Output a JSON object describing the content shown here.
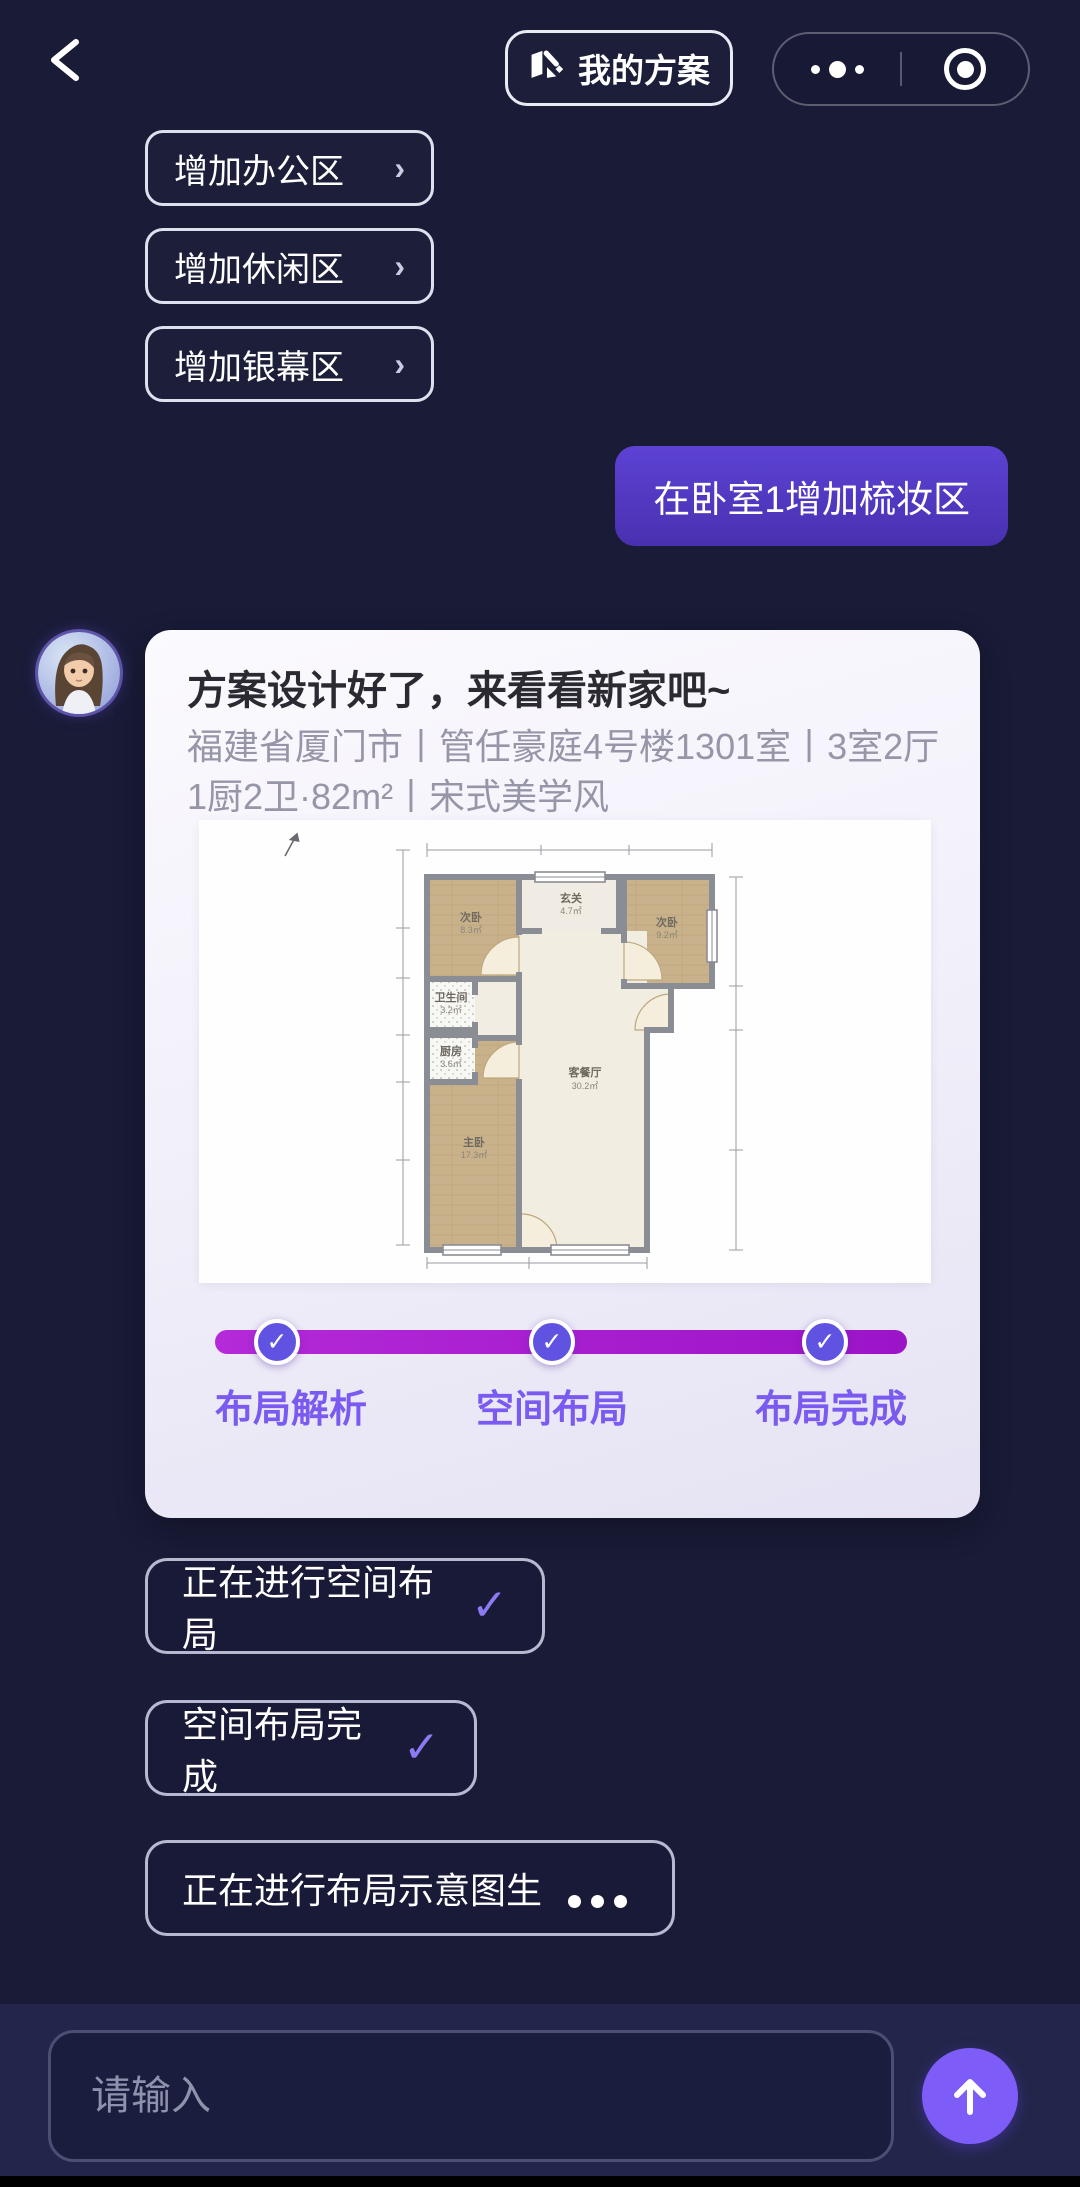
{
  "header": {
    "plan_button_label": "我的方案",
    "icons": {
      "back": "‹",
      "more": "•••",
      "record": "target-ring",
      "plan": "folded-map"
    }
  },
  "suggestions": [
    {
      "label": "增加办公区",
      "chevron": "›"
    },
    {
      "label": "增加休闲区",
      "chevron": "›"
    },
    {
      "label": "增加银幕区",
      "chevron": "›"
    }
  ],
  "user_message": {
    "text": "在卧室1增加梳妆区"
  },
  "assistant": {
    "title": "方案设计好了，来看看新家吧~",
    "subtitle": "福建省厦门市丨管任豪庭4号楼1301室丨3室2厅1厨2卫·82m²丨宋式美学风",
    "floorplan": {
      "rooms": {
        "bed_top_left": {
          "name": "次卧",
          "area": "8.3㎡"
        },
        "entry_hall": {
          "name": "玄关",
          "area": "4.7㎡"
        },
        "bed_top_right": {
          "name": "次卧",
          "area": "9.2㎡"
        },
        "bathroom": {
          "name": "卫生间",
          "area": "3.2㎡"
        },
        "kitchen": {
          "name": "厨房",
          "area": "3.6㎡"
        },
        "living_dining": {
          "name": "客餐厅",
          "area": "30.2㎡"
        },
        "master_bed": {
          "name": "主卧",
          "area": "17.3㎡"
        }
      }
    },
    "progress": {
      "check_icon": "✓",
      "steps": [
        {
          "label": "布局解析",
          "state": "done"
        },
        {
          "label": "空间布局",
          "state": "done"
        },
        {
          "label": "布局完成",
          "state": "done"
        }
      ]
    }
  },
  "status_chips": [
    {
      "label": "正在进行空间布局",
      "icon": "check"
    },
    {
      "label": "空间布局完成",
      "icon": "check"
    },
    {
      "label": "正在进行布局示意图生",
      "icon": "loading-dots"
    }
  ],
  "icons": {
    "check": "✓",
    "send": "up-arrow"
  },
  "composer": {
    "placeholder": "请输入"
  },
  "colors": {
    "background": "#191b37",
    "bubble_purple": "#5338c6",
    "progress_magenta": "#a91fd0",
    "badge_indigo": "#6053e2",
    "step_label_purple": "#7a5af0",
    "accent_send": "#7e5cf8",
    "card_bg": "#f6f4fb"
  }
}
